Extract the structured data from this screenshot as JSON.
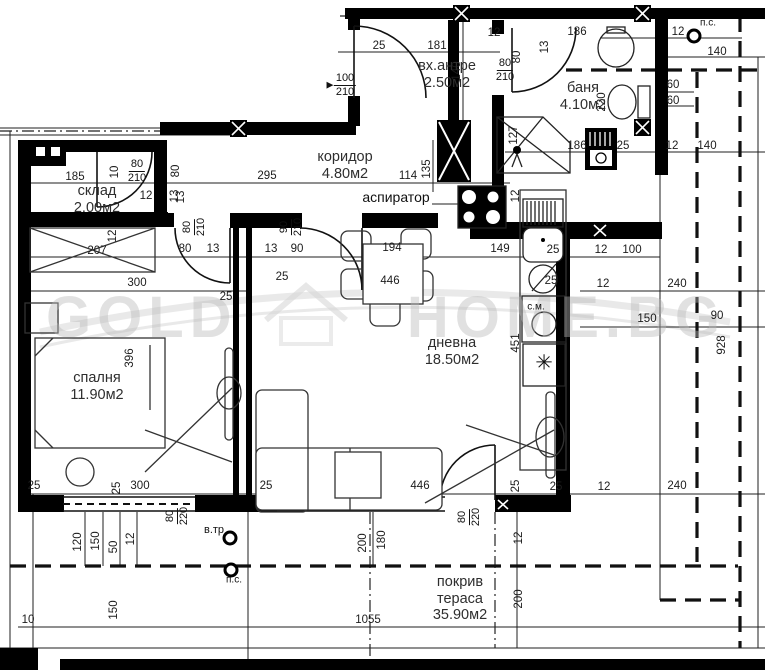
{
  "plan": {
    "watermark": {
      "part1": "GOLD",
      "part2": "HOME.BG"
    },
    "rooms": [
      {
        "lines": [
          "склад",
          "2.00м2"
        ],
        "x": 97,
        "y": 183
      },
      {
        "lines": [
          "вх.антре",
          "2.50м2"
        ],
        "x": 447,
        "y": 58
      },
      {
        "lines": [
          "баня",
          "4.10м2"
        ],
        "x": 583,
        "y": 80
      },
      {
        "lines": [
          "коридор",
          "4.80м2"
        ],
        "x": 345,
        "y": 149
      },
      {
        "lines": [
          "дневна",
          "18.50м2"
        ],
        "x": 452,
        "y": 335
      },
      {
        "lines": [
          "спалня",
          "11.90м2"
        ],
        "x": 97,
        "y": 370
      },
      {
        "lines": [
          "покрив",
          "тераса",
          "35.90м2"
        ],
        "x": 460,
        "y": 574
      }
    ],
    "annotations": [
      [
        "аспиратор",
        396,
        197,
        14
      ],
      [
        "с.м.",
        536,
        307,
        10
      ],
      [
        "в.тр",
        214,
        530,
        11
      ],
      [
        "п.с.",
        234,
        580,
        10
      ],
      [
        "п.с.",
        708,
        23,
        10
      ],
      [
        "✳",
        544,
        363,
        21
      ],
      [
        "▶",
        330,
        85,
        9
      ]
    ],
    "door_labels": [
      [
        "80",
        "210",
        137,
        171,
        0
      ],
      [
        "100",
        "210",
        345,
        85,
        0
      ],
      [
        "80",
        "210",
        505,
        70,
        0
      ],
      [
        "80",
        "210",
        194,
        227,
        1
      ],
      [
        "90",
        "210",
        291,
        227,
        1
      ],
      [
        "80",
        "220",
        177,
        516,
        1
      ],
      [
        "80",
        "220",
        469,
        517,
        1
      ]
    ],
    "dimensions": [
      [
        "185",
        75,
        177,
        0
      ],
      [
        "10",
        115,
        172,
        1
      ],
      [
        "12",
        146,
        196,
        0
      ],
      [
        "80",
        176,
        171,
        1
      ],
      [
        "13",
        181,
        197,
        1
      ],
      [
        "25",
        379,
        46,
        0
      ],
      [
        "181",
        437,
        46,
        0
      ],
      [
        "140",
        457,
        71,
        1
      ],
      [
        "12",
        494,
        33,
        0
      ],
      [
        "80",
        517,
        57,
        1
      ],
      [
        "13",
        545,
        47,
        1
      ],
      [
        "186",
        577,
        32,
        0
      ],
      [
        "12",
        678,
        32,
        0
      ],
      [
        "140",
        717,
        52,
        0
      ],
      [
        "60",
        673,
        85,
        0
      ],
      [
        "60",
        673,
        101,
        0
      ],
      [
        "220",
        602,
        102,
        1
      ],
      [
        "127",
        514,
        135,
        1
      ],
      [
        "186",
        577,
        146,
        0
      ],
      [
        "25",
        623,
        146,
        0
      ],
      [
        "12",
        672,
        146,
        0
      ],
      [
        "140",
        707,
        146,
        0
      ],
      [
        "295",
        267,
        176,
        0
      ],
      [
        "114",
        408,
        176,
        0
      ],
      [
        "135",
        427,
        169,
        1
      ],
      [
        "12",
        516,
        196,
        1
      ],
      [
        "13",
        175,
        196,
        1
      ],
      [
        "207",
        97,
        251,
        0
      ],
      [
        "12",
        113,
        236,
        1
      ],
      [
        "80",
        185,
        249,
        0
      ],
      [
        "13",
        213,
        249,
        0
      ],
      [
        "13",
        271,
        249,
        0
      ],
      [
        "90",
        297,
        249,
        0
      ],
      [
        "194",
        392,
        248,
        0
      ],
      [
        "149",
        500,
        249,
        0
      ],
      [
        "25",
        553,
        250,
        0
      ],
      [
        "12",
        601,
        250,
        0
      ],
      [
        "100",
        632,
        250,
        0
      ],
      [
        "300",
        137,
        283,
        0
      ],
      [
        "25",
        282,
        277,
        0
      ],
      [
        "25",
        226,
        297,
        0
      ],
      [
        "446",
        390,
        281,
        0
      ],
      [
        "25",
        551,
        281,
        0
      ],
      [
        "12",
        603,
        284,
        0
      ],
      [
        "240",
        677,
        284,
        0
      ],
      [
        "150",
        647,
        319,
        0
      ],
      [
        "90",
        717,
        316,
        0
      ],
      [
        "928",
        722,
        345,
        1
      ],
      [
        "451",
        516,
        343,
        1
      ],
      [
        "396",
        130,
        358,
        1
      ],
      [
        "25",
        34,
        486,
        0
      ],
      [
        "25",
        117,
        488,
        1
      ],
      [
        "300",
        140,
        486,
        0
      ],
      [
        "120",
        78,
        542,
        1
      ],
      [
        "150",
        96,
        541,
        1
      ],
      [
        "50",
        114,
        547,
        1
      ],
      [
        "12",
        131,
        539,
        1
      ],
      [
        "25",
        266,
        486,
        0
      ],
      [
        "446",
        420,
        486,
        0
      ],
      [
        "200",
        363,
        543,
        1
      ],
      [
        "180",
        382,
        540,
        1
      ],
      [
        "25",
        516,
        486,
        1
      ],
      [
        "25",
        556,
        487,
        0
      ],
      [
        "12",
        604,
        487,
        0
      ],
      [
        "240",
        677,
        486,
        0
      ],
      [
        "12",
        519,
        538,
        1
      ],
      [
        "200",
        519,
        599,
        1
      ],
      [
        "10",
        28,
        620,
        0
      ],
      [
        "150",
        114,
        610,
        1
      ],
      [
        "1055",
        368,
        620,
        0
      ]
    ]
  }
}
